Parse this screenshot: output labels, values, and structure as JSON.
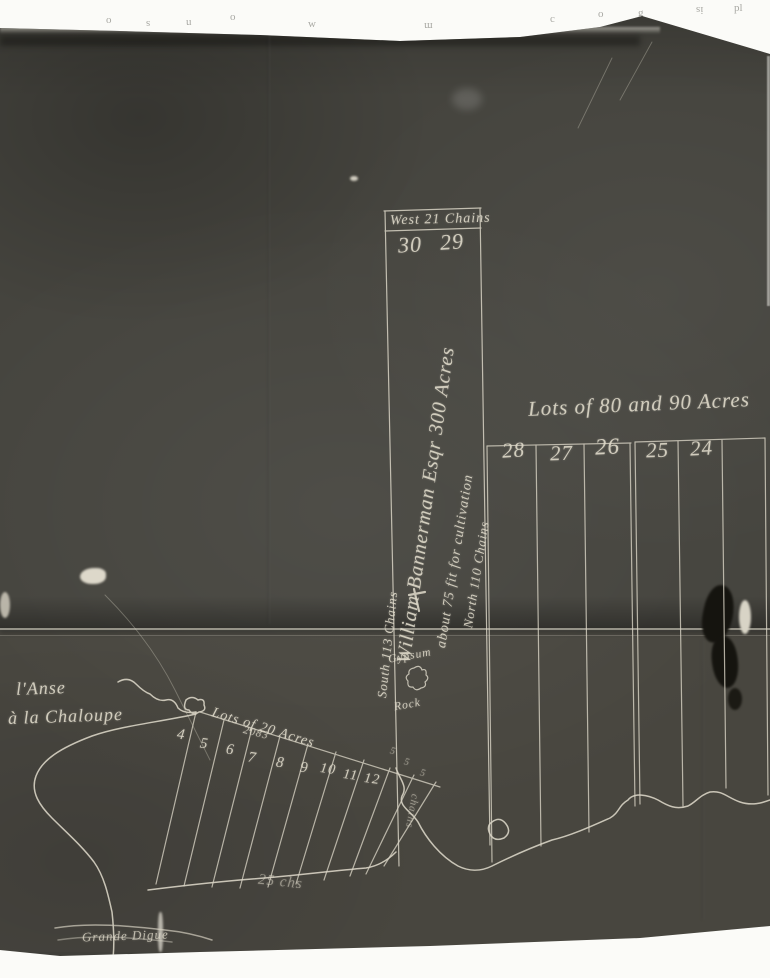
{
  "colors": {
    "photo_background": "#45443e",
    "survey_line": "#d8d3c4",
    "ink": "#ddd8c8",
    "margin": "#fbfbf8"
  },
  "edge_fragments": [
    "o",
    "s",
    "u",
    "o",
    "w",
    "m",
    "c",
    "o",
    "g",
    "is",
    "pl"
  ],
  "main_strip": {
    "top_measure": "West 21 Chains",
    "lot_numbers": [
      "30",
      "29"
    ],
    "west_measure": "South 113 Chains",
    "east_measure": "North 110 Chains",
    "owner_line": "William Bannerman Esqr 300 Acres",
    "cultivation_line": "about 75 fit for cultivation"
  },
  "east_lots": {
    "header": "Lots of 80 and 90 Acres",
    "numbers": [
      "28",
      "27",
      "26",
      "25",
      "24"
    ]
  },
  "shore_lots": {
    "header": "Lots of 20 Acres",
    "numbers": [
      "4",
      "5",
      "6",
      "7",
      "8",
      "9",
      "10",
      "11",
      "12"
    ],
    "plan_number": "2083",
    "ticks": [
      "5",
      "5",
      "5"
    ],
    "measure": "25 chs",
    "side_note": "chains"
  },
  "places": {
    "cove_line1": "l'Anse",
    "cove_line2": "à la Chaloupe",
    "gypsum_line1": "Gypsum",
    "gypsum_line2": "Rock",
    "dike": "Grande Digue"
  }
}
